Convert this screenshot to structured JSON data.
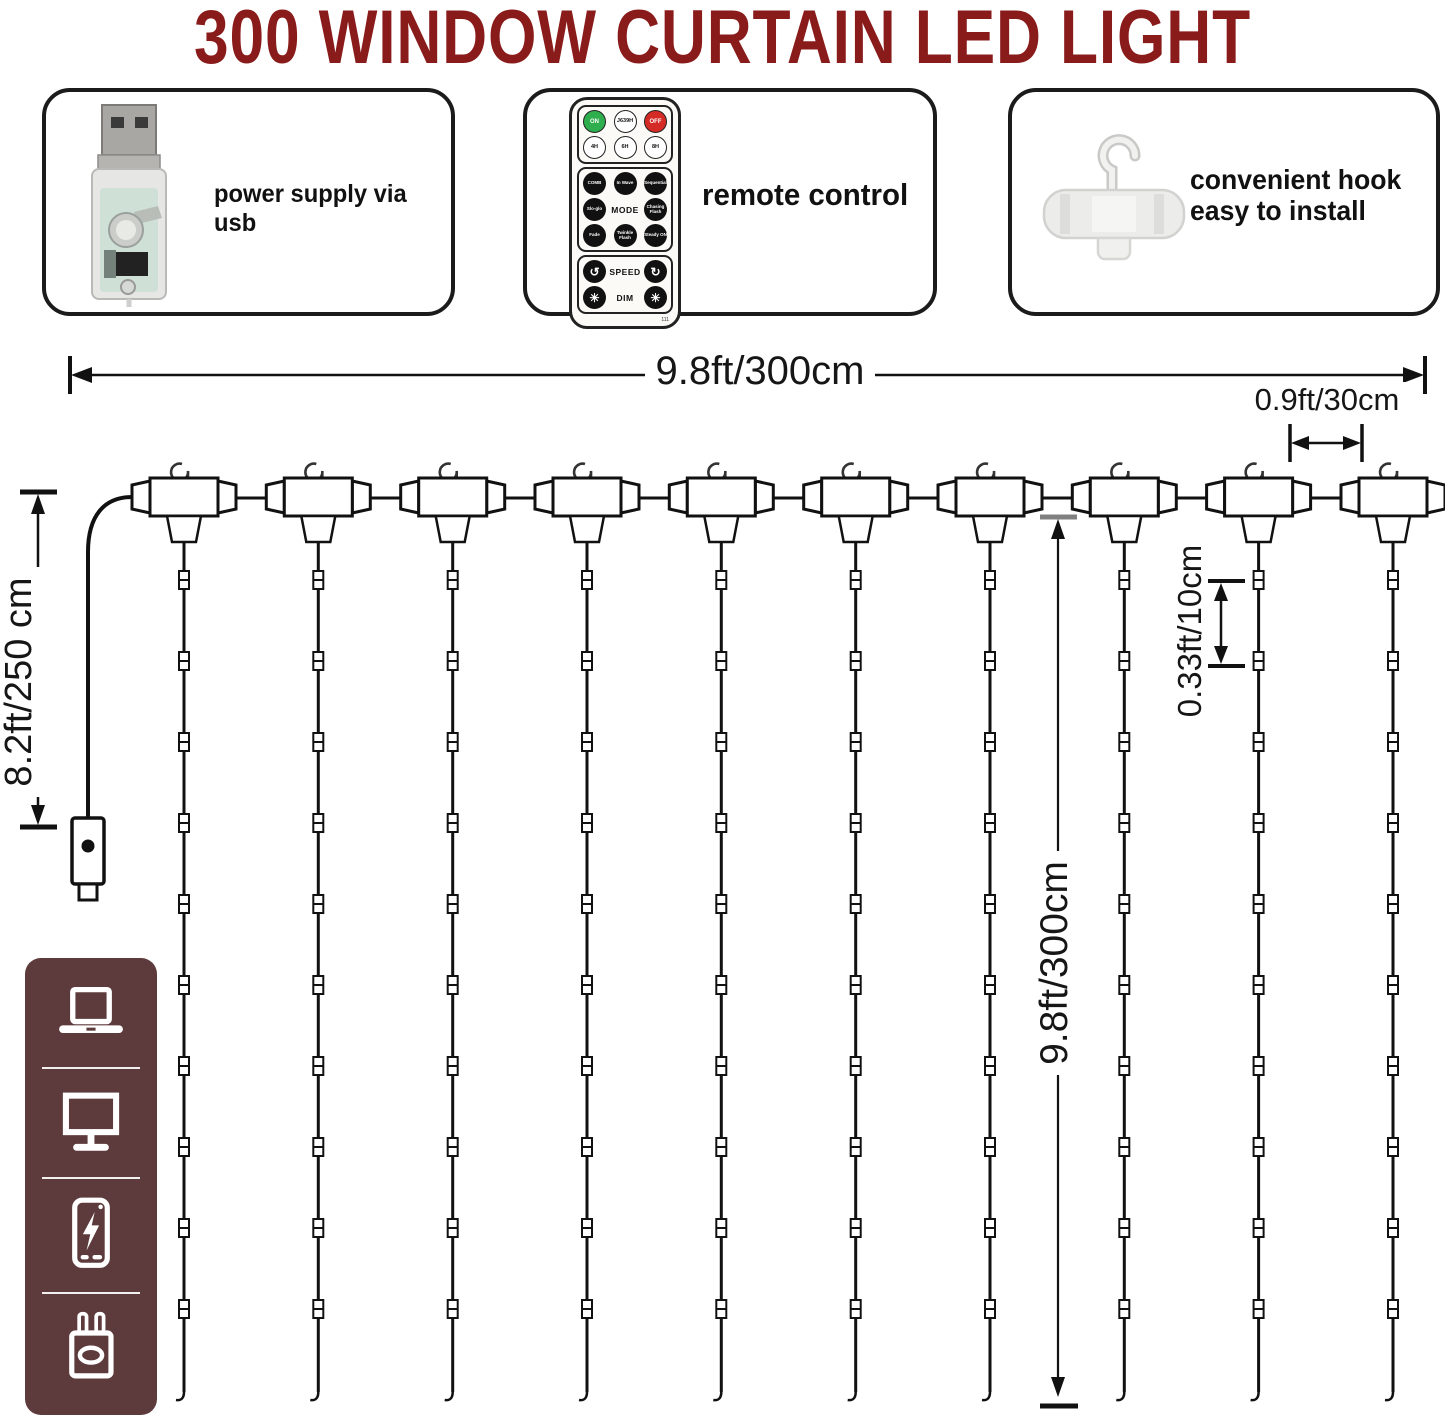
{
  "title": "300 WINDOW CURTAIN LED LIGHT",
  "features": {
    "usb": {
      "label": "power supply via usb"
    },
    "remote": {
      "label": "remote control"
    },
    "hook": {
      "label_line1": "convenient hook",
      "label_line2": "easy to install"
    }
  },
  "remote_control": {
    "power_row": [
      "ON",
      "J639H",
      "OFF"
    ],
    "timer_row": [
      "4H",
      "6H",
      "8H"
    ],
    "mode_grid": [
      "COMB",
      "In Wave",
      "Sequential",
      "Slo-glo",
      "MODE",
      "Chasing Flash",
      "Fade",
      "Twinkle Flash",
      "Steady ON"
    ],
    "speed_label": "SPEED",
    "dim_label": "DIM",
    "speed_icons": [
      "↺",
      "↻"
    ],
    "dim_icons": [
      "☀",
      "☀"
    ],
    "model_code": "111"
  },
  "dimensions": {
    "total_width": "9.8ft/300cm",
    "hook_spacing": "0.9ft/30cm",
    "power_cord": "8.2ft/250 cm",
    "led_spacing": "0.33ft/10cm",
    "drop_height": "9.8ft/300cm"
  },
  "diagram": {
    "hook_count": 10,
    "leds_per_string_marks": 10
  },
  "sidebar": {
    "icons": [
      "laptop",
      "monitor",
      "power-bank",
      "usb-adapter"
    ]
  },
  "colors": {
    "title_red": "#8a1b1b",
    "sidebar_maroon": "#5d3b3c",
    "on_green": "#2fae4d",
    "off_red": "#d42b26",
    "line_black": "#111111"
  }
}
